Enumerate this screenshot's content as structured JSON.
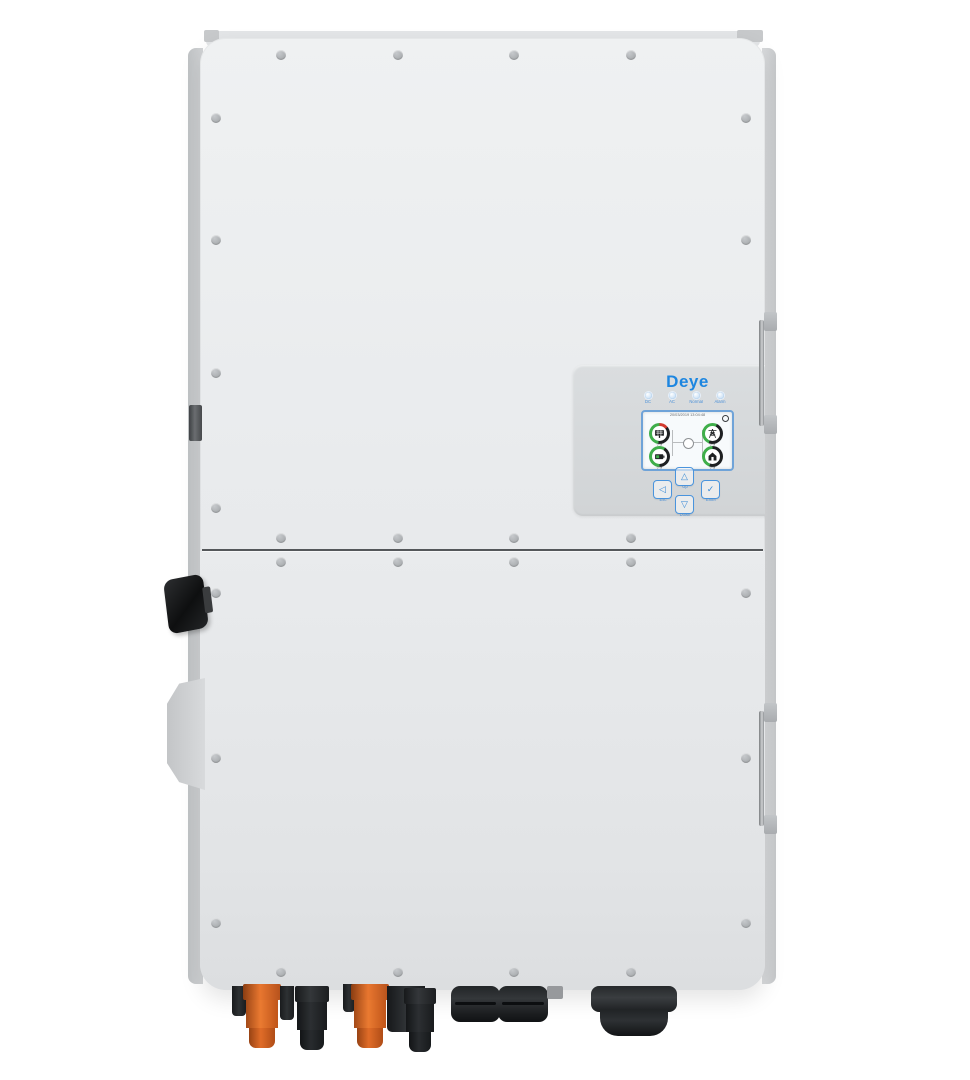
{
  "device": {
    "brand_logo": "Deye",
    "panel": {
      "leds": [
        {
          "label": "DC"
        },
        {
          "label": "AC"
        },
        {
          "label": "Normal"
        },
        {
          "label": "Alarm"
        }
      ],
      "screen": {
        "datetime": "20/03/2019 13:04:48",
        "gauges": [
          {
            "name": "pv",
            "value": "0 W"
          },
          {
            "name": "grid",
            "value": "0 W"
          },
          {
            "name": "battery",
            "value": "0 W"
          },
          {
            "name": "load",
            "value": "0 W"
          }
        ]
      },
      "buttons": [
        {
          "glyph": "◁",
          "label": "Esc"
        },
        {
          "glyph": "△",
          "label": "Up"
        },
        {
          "glyph": "✓",
          "label": "Enter"
        },
        {
          "glyph": "▽",
          "label": "Down"
        }
      ]
    },
    "colors": {
      "accent_blue": "#1d86e0",
      "body_gray": "#e9ebed",
      "panel_gray": "#d6d9db",
      "connector_orange": "#e06c28",
      "connector_black": "#1c1e20",
      "gauge_green": "#3fae4a",
      "gauge_red": "#d23a2e",
      "gauge_dark": "#1e2022"
    }
  }
}
